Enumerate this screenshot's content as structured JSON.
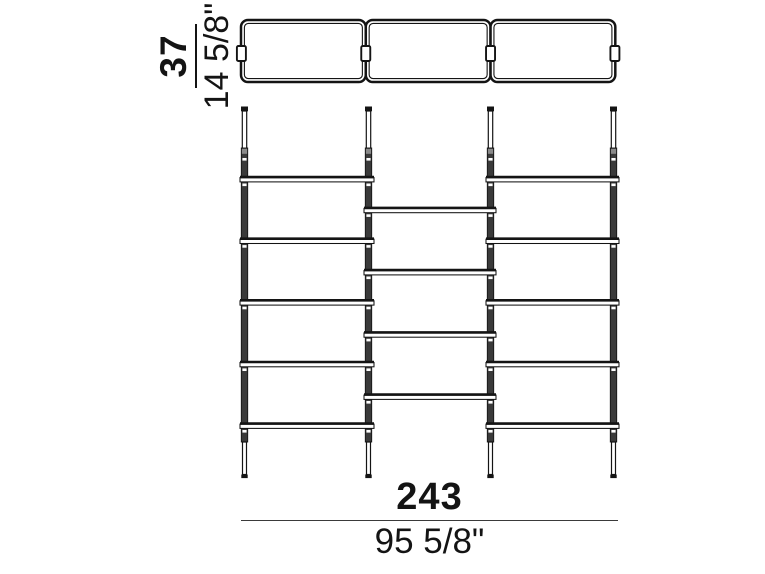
{
  "drawing": {
    "subject": "wall-bookcase-technical-drawing",
    "views": {
      "plan_view_modules": 3,
      "elevation_posts": 4,
      "elevation_outer_bay_shelves": 5,
      "elevation_middle_bay_shelves": 4
    }
  },
  "dimensions": {
    "depth": {
      "cm": "37",
      "inches": "14 5/8\""
    },
    "width": {
      "cm": "243",
      "inches": "95 5/8\""
    }
  },
  "colors": {
    "line": "#141414",
    "post_fill": "#3a3a3a",
    "sleeve_fill": "#8a8a8a",
    "background": "#ffffff"
  }
}
